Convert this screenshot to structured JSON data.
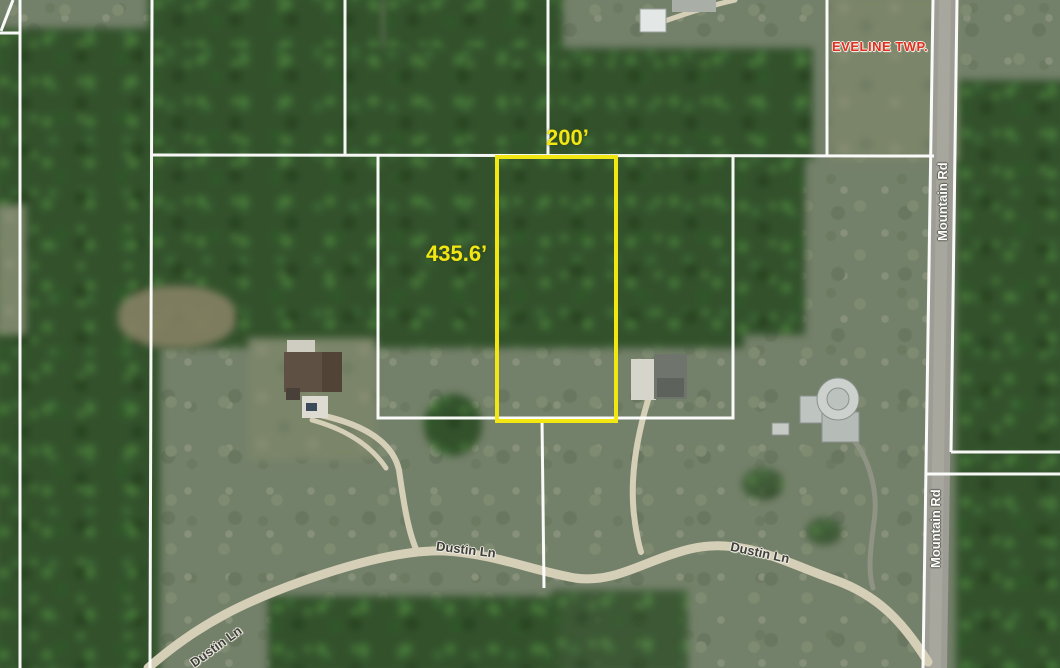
{
  "map": {
    "township": {
      "label": "EVELINE TWP."
    },
    "parcel": {
      "frontage_label": "200’",
      "depth_label": "435.6’",
      "outline_color": "#f2e713"
    },
    "roads": {
      "dustin_ln": "Dustin Ln",
      "mountain_rd": "Mountain Rd"
    },
    "colors": {
      "boundary_line": "#ffffff",
      "township_text": "#e02f23",
      "road_label_text_dark": "#3f3f3c",
      "road_label_text_light": "#fbfbf8"
    }
  }
}
